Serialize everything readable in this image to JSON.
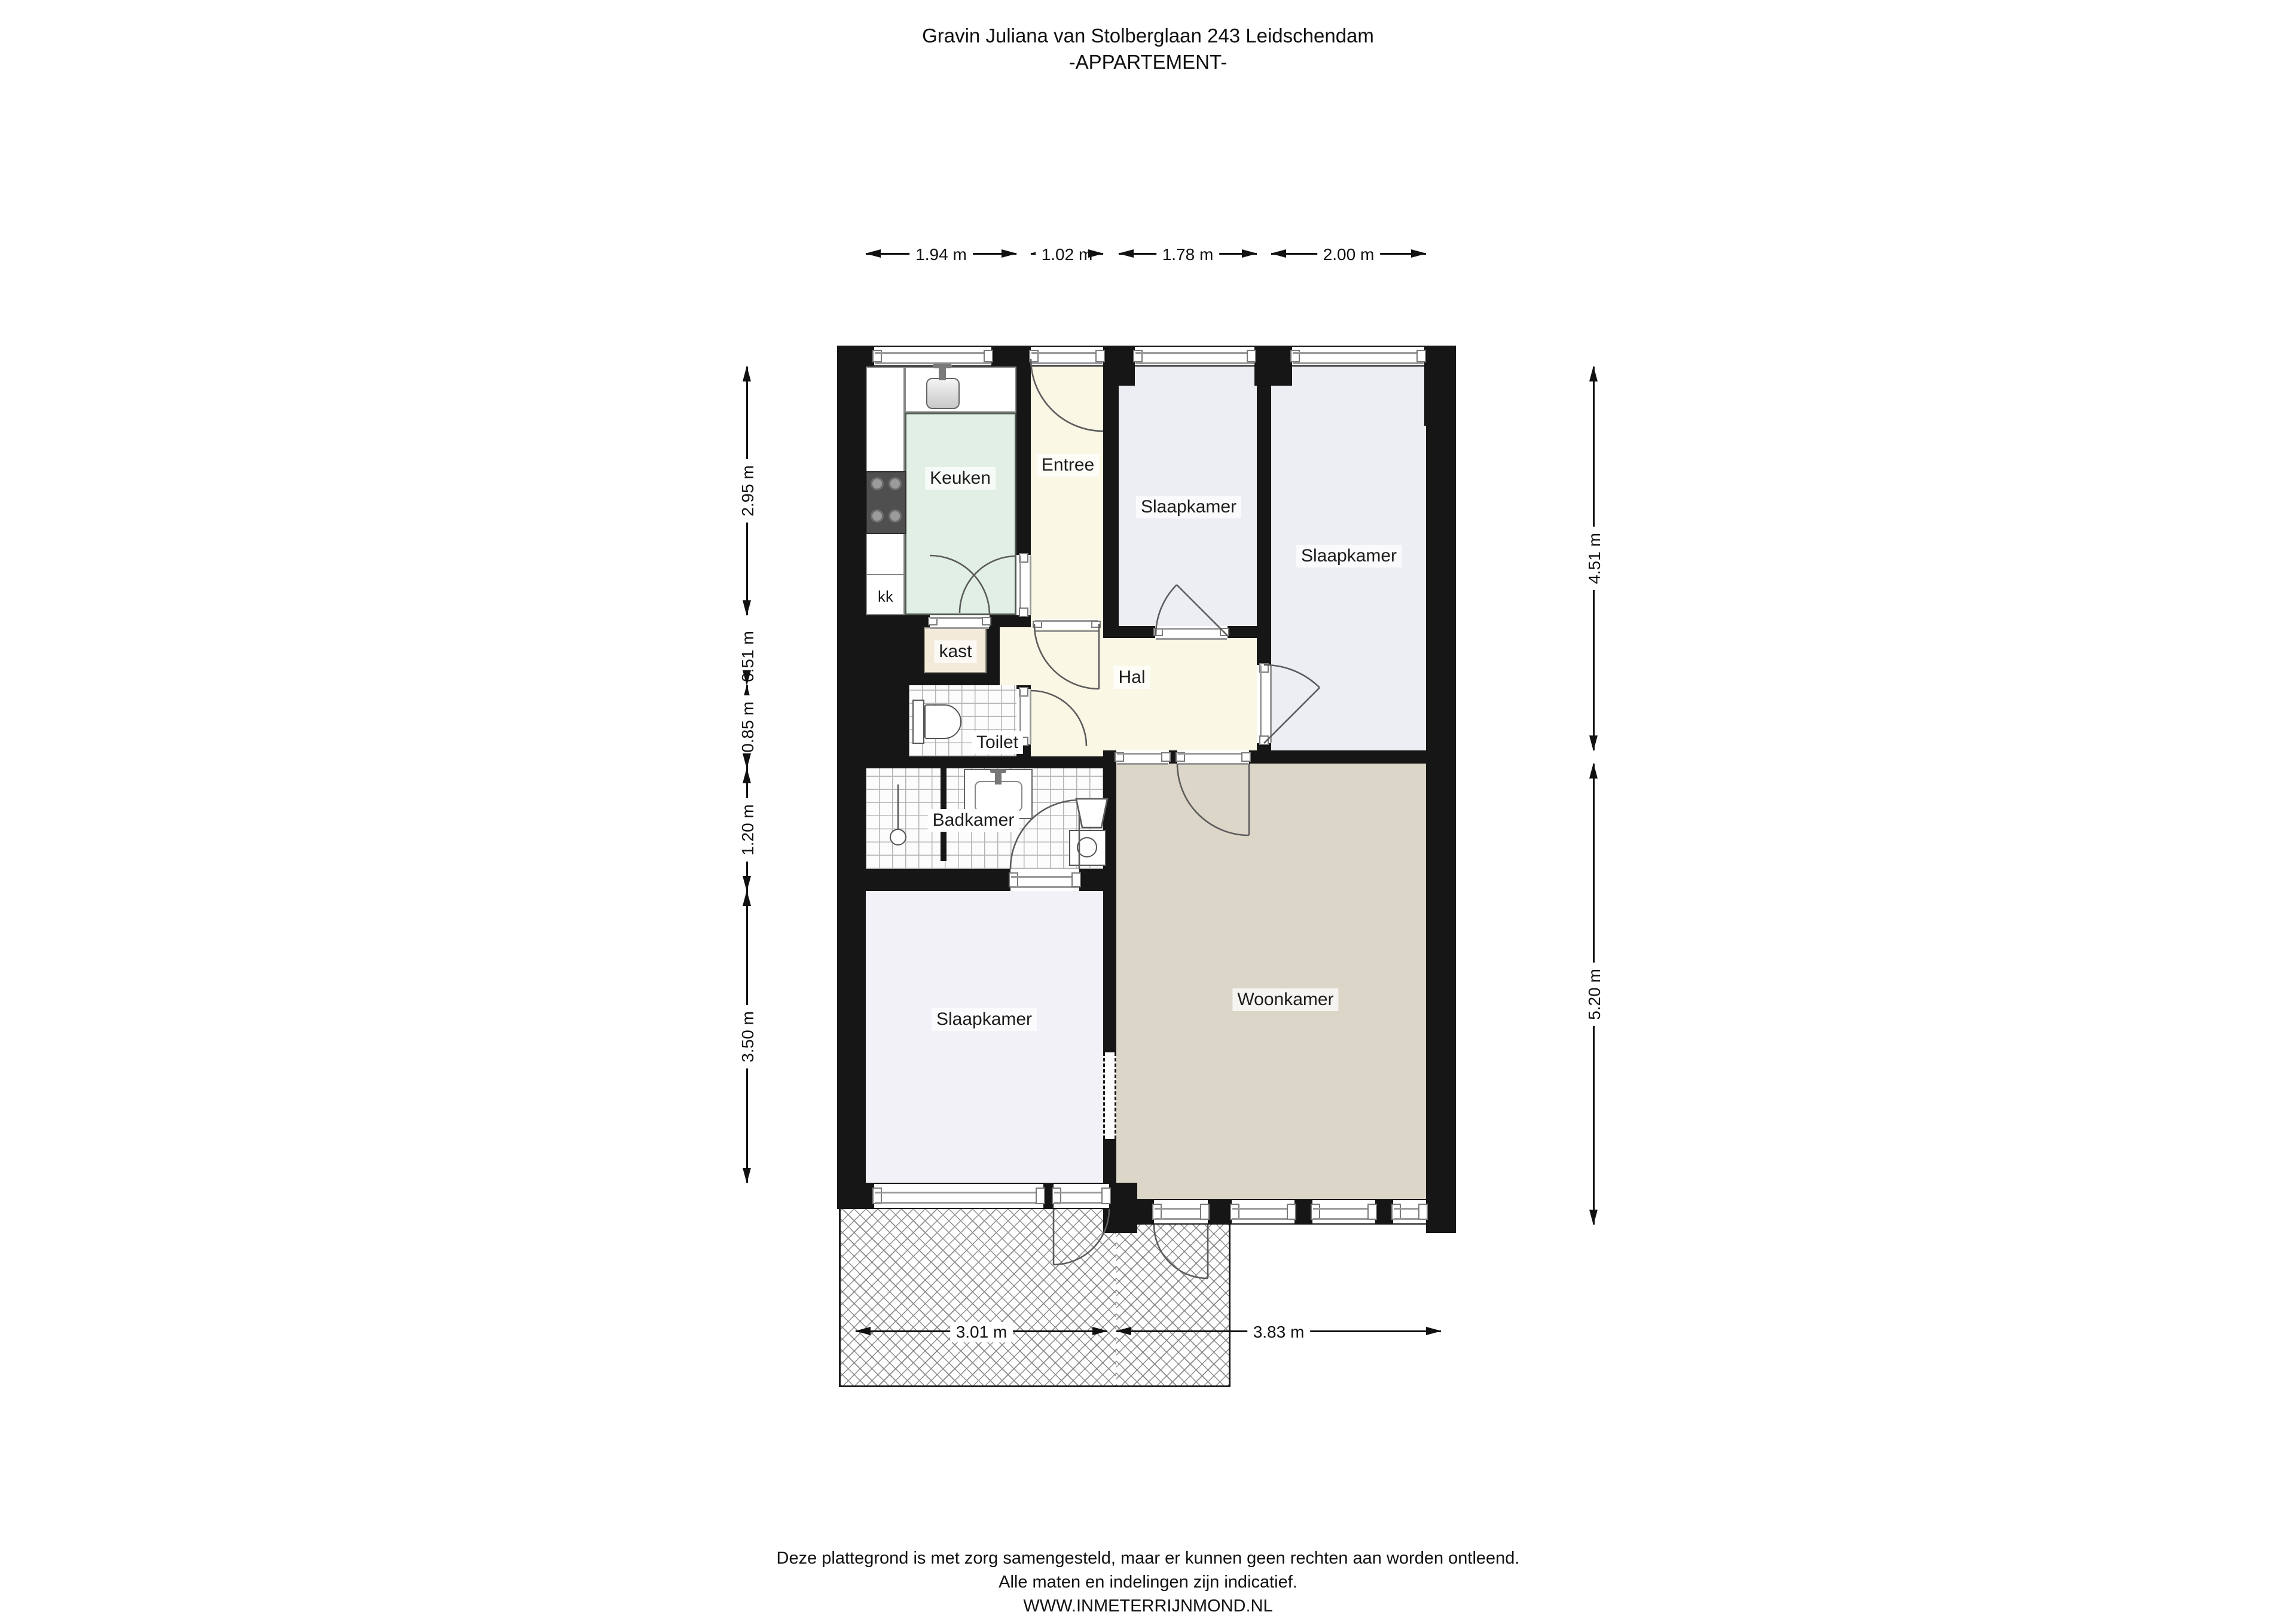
{
  "title": {
    "line1": "Gravin Juliana van Stolberglaan 243 Leidschendam",
    "line2": "-APPARTEMENT-"
  },
  "rooms": {
    "keuken": "Keuken",
    "entree": "Entree",
    "slaapkamer1": "Slaapkamer",
    "slaapkamer2": "Slaapkamer",
    "slaapkamer3": "Slaapkamer",
    "woonkamer": "Woonkamer",
    "hal": "Hal",
    "toilet": "Toilet",
    "badkamer": "Badkamer",
    "kast": "kast",
    "kk": "kk"
  },
  "dimensions": {
    "top": [
      "1.94 m",
      "1.02 m",
      "1.78 m",
      "2.00 m"
    ],
    "left": [
      "2.95 m",
      "0.51 m",
      "0.85 m",
      "1.20 m",
      "3.50 m"
    ],
    "right": [
      "4.51 m",
      "5.20 m"
    ],
    "bottom": [
      "3.01 m",
      "3.83 m"
    ]
  },
  "footer": {
    "line1": "Deze plattegrond is met zorg samengesteld, maar er kunnen geen rechten aan worden ontleend.",
    "line2": "Alle maten en indelingen zijn indicatief.",
    "line3": "WWW.INMETERRIJNMOND.NL"
  },
  "colors": {
    "wall": "#161616",
    "hall": "#FAF7E5",
    "kitchen": "#E2EFE5",
    "bedroom": "#EDEDF4",
    "living": "#DCD6C8",
    "closet": "#F3EADA"
  }
}
